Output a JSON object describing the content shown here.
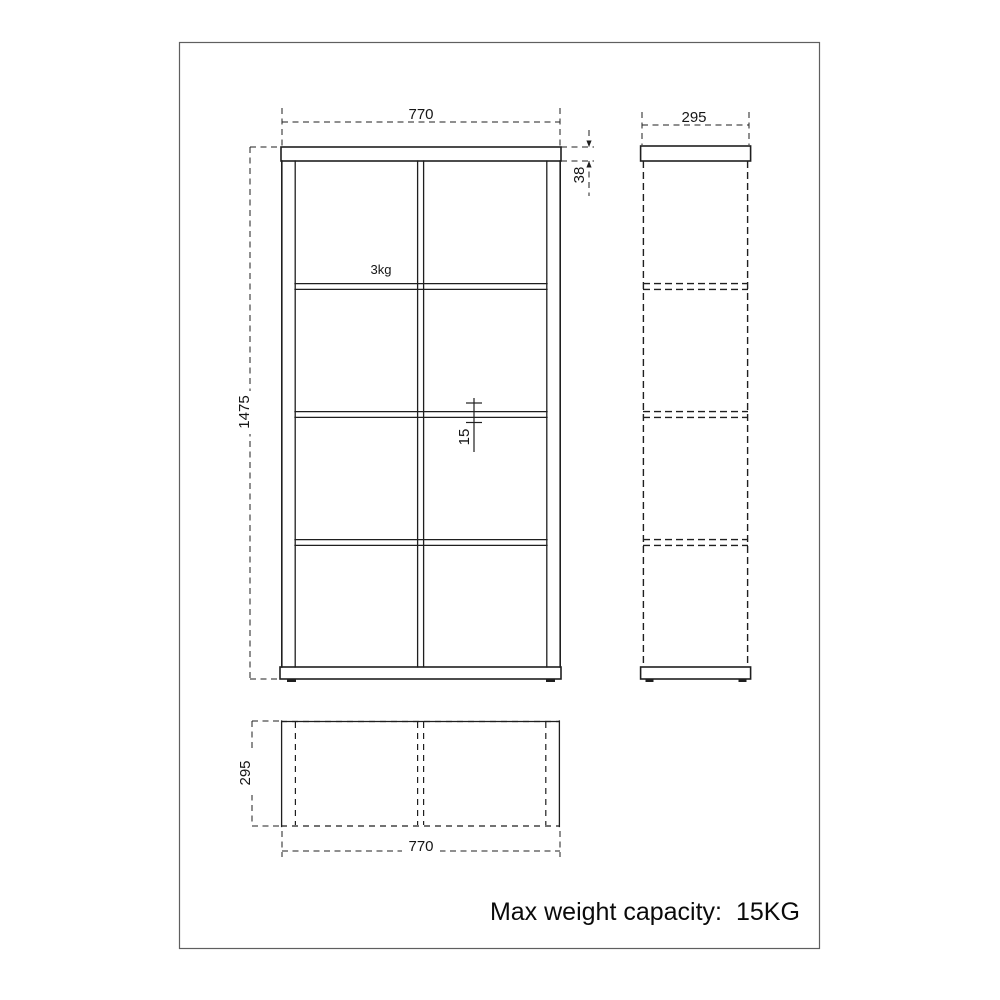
{
  "page": {
    "background": "#ffffff",
    "frame_color": "#5f5f5f",
    "line_color": "#1f1f1f",
    "note_label": "Max weight capacity:",
    "note_value": "15KG"
  },
  "front_view": {
    "width": "770",
    "height": "1475",
    "top_thickness": "38",
    "shelf_load": "3kg",
    "shelf_thickness": "15"
  },
  "side_view": {
    "depth": "295"
  },
  "top_view": {
    "depth": "295",
    "width": "770"
  }
}
